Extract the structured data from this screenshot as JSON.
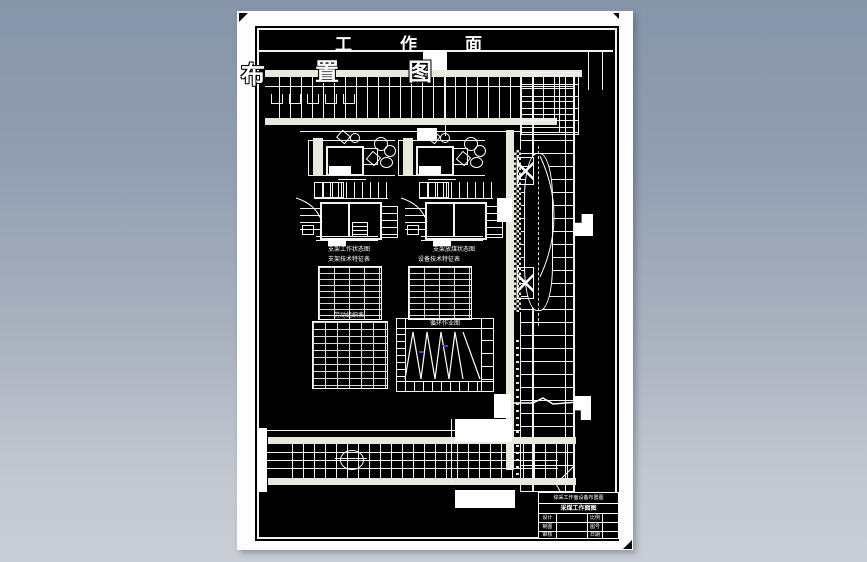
{
  "drawing": {
    "banner_chars": [
      "工",
      "作",
      "面"
    ],
    "overlay_chars": [
      "布",
      "置",
      "图"
    ],
    "captions": {
      "support_left": "支架工作状态图",
      "support_right": "支架放煤状态图",
      "table_left_title": "支架技术特征表",
      "table_right_title": "设备技术特征表",
      "labor_table_title": "劳动组织表",
      "cycle_chart_title": "循环作业图"
    },
    "cycle_chart": {
      "type": "line",
      "description": "工作面循环作业图（班次进度三角波）",
      "waves": 4
    },
    "title_block": {
      "line1": "综采工作面设备布置图",
      "line2": "采煤工作面图",
      "fields": {
        "design": "设计",
        "draft": "制图",
        "check": "审核",
        "scale": "比例",
        "number": "图号",
        "date": "日期"
      }
    },
    "colors": {
      "paper": "#fdfdfd",
      "ink": "#f2f2f2",
      "field": "#000000",
      "rail": "#e9e8dd",
      "background_top": "#8795aa",
      "background_bottom": "#c9ced6",
      "accent_blue": "#3a49d0"
    }
  }
}
